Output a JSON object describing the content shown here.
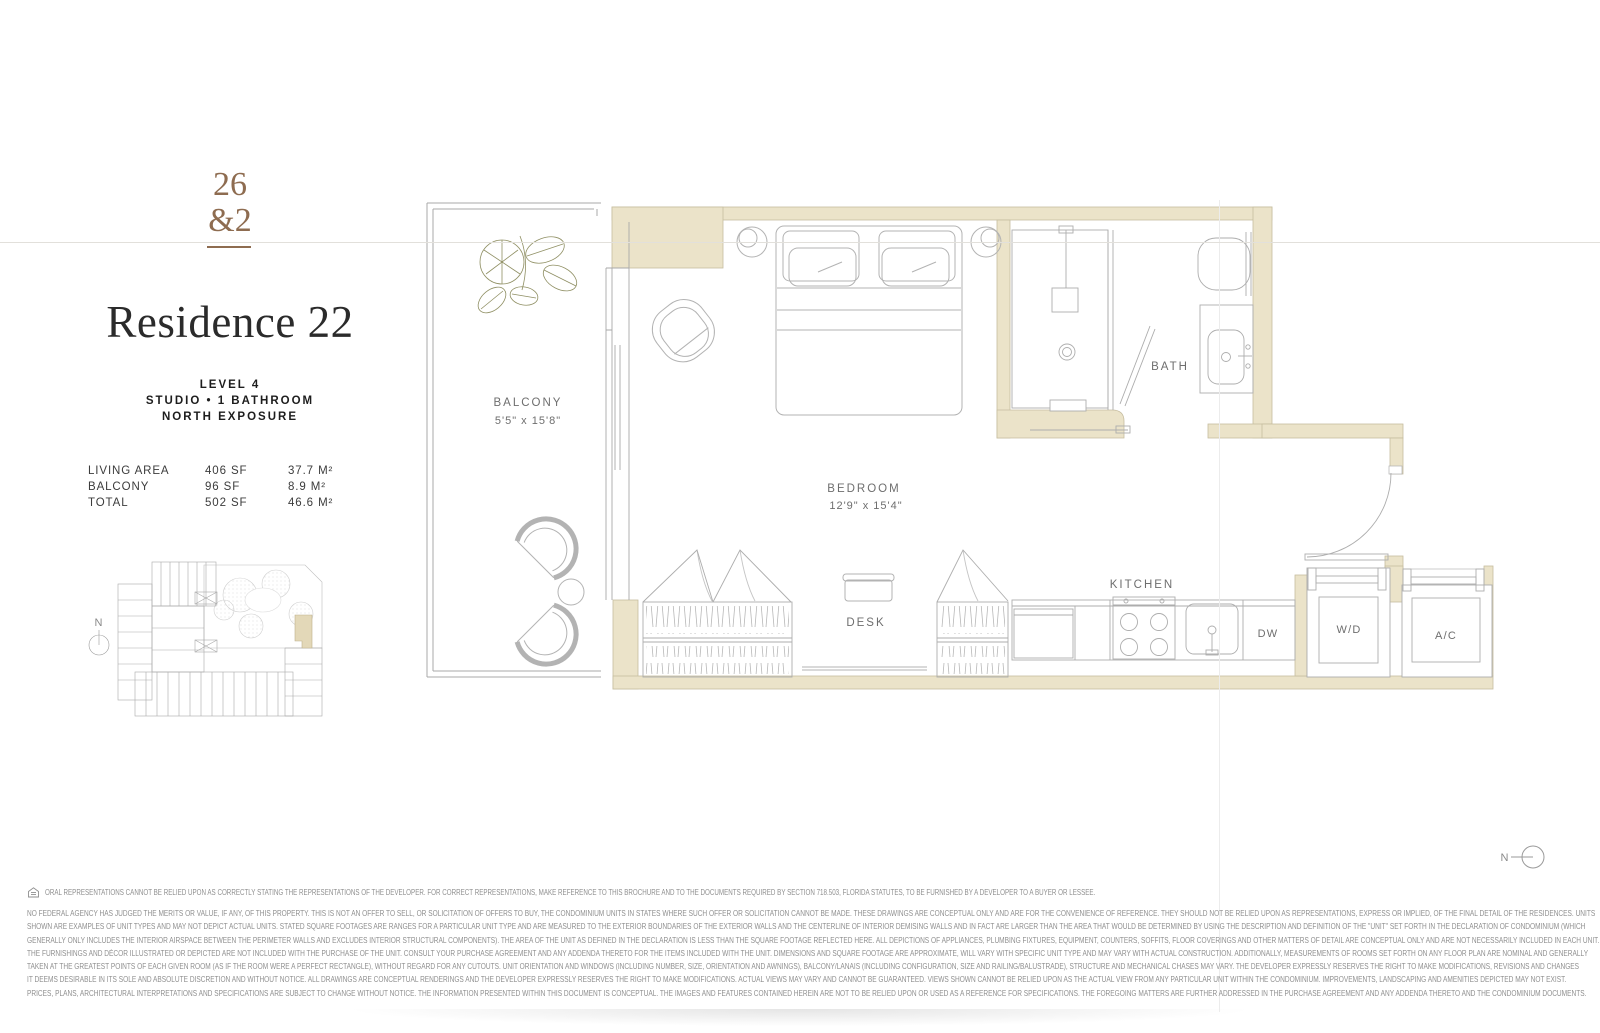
{
  "brand": {
    "logo_line1": "26",
    "logo_line2": "&2",
    "logo_color": "#8e6c50"
  },
  "header": {
    "title": "Residence 22",
    "level": "LEVEL 4",
    "unit_type": "STUDIO • 1 BATHROOM",
    "exposure": "NORTH EXPOSURE"
  },
  "area_table": {
    "rows": [
      {
        "label": "LIVING AREA",
        "sf": "406 SF",
        "m2": "37.7 M²"
      },
      {
        "label": "BALCONY",
        "sf": "96 SF",
        "m2": "8.9 M²"
      },
      {
        "label": "TOTAL",
        "sf": "502 SF",
        "m2": "46.6 M²"
      }
    ]
  },
  "keyplan": {
    "north_label": "N"
  },
  "floorplan": {
    "wall_color": "#ebe3c9",
    "north_label": "N",
    "rooms": {
      "balcony": {
        "label": "BALCONY",
        "dims": "5'5\" x 15'8\""
      },
      "bedroom": {
        "label": "BEDROOM",
        "dims": "12'9\" x 15'4\""
      },
      "bath": {
        "label": "BATH"
      },
      "kitchen": {
        "label": "KITCHEN"
      },
      "desk": {
        "label": "DESK"
      },
      "dishwasher": {
        "label": "DW"
      },
      "washer_dryer": {
        "label": "W/D"
      },
      "air_conditioner": {
        "label": "A/C"
      }
    }
  },
  "disclaimer": {
    "line1": "ORAL REPRESENTATIONS CANNOT BE RELIED UPON AS CORRECTLY STATING THE REPRESENTATIONS OF THE DEVELOPER. FOR CORRECT REPRESENTATIONS, MAKE REFERENCE TO THIS BROCHURE AND TO THE DOCUMENTS REQUIRED BY SECTION 718.503, FLORIDA STATUTES, TO BE FURNISHED BY A DEVELOPER TO A BUYER OR LESSEE.",
    "lines": [
      "NO FEDERAL AGENCY HAS JUDGED THE MERITS OR VALUE, IF ANY, OF THIS PROPERTY. THIS IS NOT AN OFFER TO SELL, OR SOLICITATION OF OFFERS TO BUY, THE CONDOMINIUM UNITS IN STATES WHERE SUCH OFFER OR SOLICITATION CANNOT BE MADE. THESE DRAWINGS ARE CONCEPTUAL ONLY AND ARE FOR THE CONVENIENCE OF REFERENCE. THEY SHOULD NOT BE RELIED UPON AS REPRESENTATIONS, EXPRESS OR IMPLIED, OF THE FINAL DETAIL OF THE RESIDENCES. UNITS",
      "SHOWN ARE EXAMPLES OF UNIT TYPES AND MAY NOT DEPICT ACTUAL UNITS. STATED SQUARE FOOTAGES ARE RANGES FOR A PARTICULAR UNIT TYPE AND ARE MEASURED TO THE EXTERIOR BOUNDARIES OF THE EXTERIOR WALLS AND THE CENTERLINE OF INTERIOR DEMISING WALLS AND IN FACT ARE LARGER THAN THE AREA THAT WOULD BE DETERMINED BY USING THE DESCRIPTION AND DEFINITION OF THE \"UNIT\" SET FORTH IN THE DECLARATION OF CONDOMINIUM (WHICH",
      "GENERALLY ONLY INCLUDES THE INTERIOR AIRSPACE BETWEEN THE PERIMETER WALLS AND EXCLUDES INTERIOR STRUCTURAL COMPONENTS). THE AREA OF THE UNIT AS DEFINED IN THE DECLARATION IS LESS THAN THE SQUARE FOOTAGE REFLECTED HERE. ALL DEPICTIONS OF APPLIANCES, PLUMBING FIXTURES, EQUIPMENT, COUNTERS, SOFFITS, FLOOR COVERINGS AND OTHER MATTERS OF DETAIL ARE CONCEPTUAL ONLY AND ARE NOT NECESSARILY INCLUDED IN EACH UNIT.",
      "THE FURNISHINGS AND DÉCOR ILLUSTRATED OR DEPICTED ARE NOT INCLUDED WITH THE PURCHASE OF THE UNIT. CONSULT YOUR PURCHASE AGREEMENT AND ANY ADDENDA THERETO FOR THE ITEMS INCLUDED WITH THE UNIT. DIMENSIONS AND SQUARE FOOTAGE ARE APPROXIMATE, WILL VARY WITH SPECIFIC UNIT TYPE AND MAY VARY WITH ACTUAL CONSTRUCTION. ADDITIONALLY, MEASUREMENTS OF ROOMS SET FORTH ON ANY FLOOR PLAN ARE NOMINAL AND GENERALLY",
      "TAKEN AT THE GREATEST POINTS OF EACH GIVEN ROOM (AS IF THE ROOM WERE A PERFECT RECTANGLE), WITHOUT REGARD FOR ANY CUTOUTS. UNIT ORIENTATION AND WINDOWS (INCLUDING NUMBER, SIZE, ORIENTATION AND AWNINGS), BALCONY/LANAIS (INCLUDING CONFIGURATION, SIZE AND RAILING/BALUSTRADE), STRUCTURE AND MECHANICAL CHASES MAY VARY. THE DEVELOPER EXPRESSLY RESERVES THE RIGHT TO MAKE MODIFICATIONS, REVISIONS AND CHANGES",
      "IT DEEMS DESIRABLE IN ITS SOLE AND ABSOLUTE DISCRETION AND WITHOUT NOTICE. ALL DRAWINGS ARE CONCEPTUAL RENDERINGS AND THE DEVELOPER EXPRESSLY RESERVES THE RIGHT TO MAKE MODIFICATIONS. ACTUAL VIEWS MAY VARY AND CANNOT BE GUARANTEED. VIEWS SHOWN CANNOT BE RELIED UPON AS THE ACTUAL VIEW FROM ANY PARTICULAR UNIT WITHIN THE CONDOMINIUM. IMPROVEMENTS, LANDSCAPING AND AMENITIES DEPICTED MAY NOT EXIST.",
      "PRICES, PLANS, ARCHITECTURAL INTERPRETATIONS AND SPECIFICATIONS ARE SUBJECT TO CHANGE WITHOUT NOTICE. THE INFORMATION PRESENTED WITHIN THIS DOCUMENT IS CONCEPTUAL. THE IMAGES AND FEATURES CONTAINED HEREIN ARE NOT TO BE RELIED UPON OR USED AS A REFERENCE FOR SPECIFICATIONS. THE FOREGOING MATTERS ARE FURTHER ADDRESSED IN THE PURCHASE AGREEMENT AND ANY ADDENDA THERETO AND THE CONDOMINIUM DOCUMENTS."
    ]
  }
}
